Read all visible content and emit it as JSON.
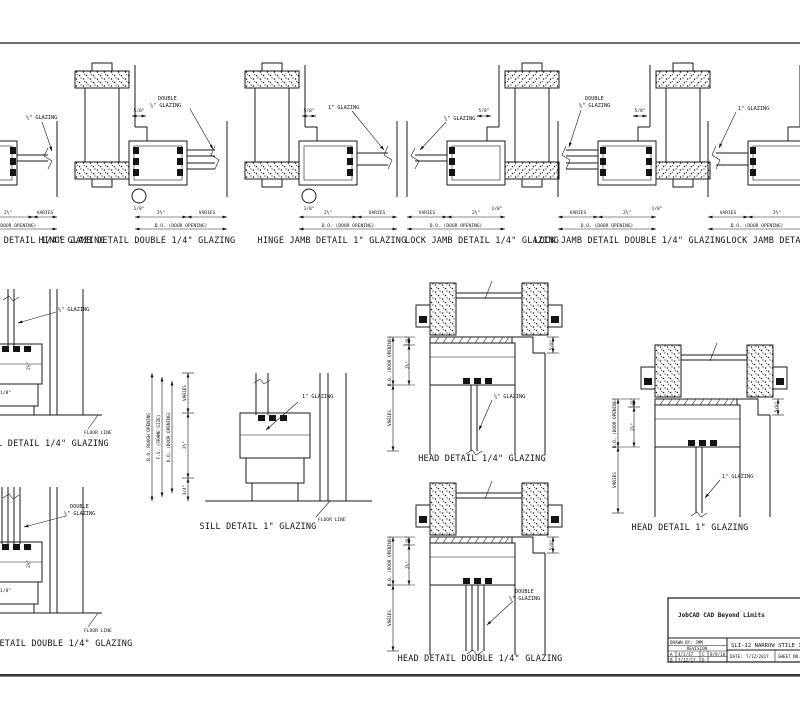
{
  "labels": {
    "glazing_quarter": "¼\" GLAZING",
    "glazing_double": "DOUBLE",
    "glazing_one": "1\" GLAZING",
    "floor_line": "FLOOR LINE",
    "varies": "VARIES",
    "door_opening": "D.O. (DOOR OPENING)",
    "rough_opening": "R.O. ROUGH OPENING",
    "frame_size": "F.S. (FRAME SIZE)",
    "dim_5_8": "5/8\"",
    "dim_1_8": "1/8\"",
    "dim_2_5": "2½\"",
    "dim_3_4": "3/4\""
  },
  "details": {
    "hinge_jamb_quarter": {
      "caption": "HINGE JAMB DETAIL 1/4\" GLAZING"
    },
    "hinge_jamb_double": {
      "caption": "HINGE JAMB DETAIL DOUBLE 1/4\" GLAZING"
    },
    "hinge_jamb_one": {
      "caption": "HINGE JAMB DETAIL 1\" GLAZING"
    },
    "lock_jamb_quarter": {
      "caption": "LOCK JAMB DETAIL 1/4\" GLAZING"
    },
    "lock_jamb_double": {
      "caption": "LOCK JAMB DETAIL DOUBLE 1/4\" GLAZING"
    },
    "lock_jamb_one": {
      "caption": "LOCK JAMB DETAIL 1\" GLAZING"
    },
    "sill_quarter": {
      "caption": "SILL DETAIL 1/4\" GLAZING"
    },
    "sill_double": {
      "caption": "SILL DETAIL DOUBLE 1/4\" GLAZING"
    },
    "sill_one": {
      "caption": "SILL DETAIL 1\" GLAZING"
    },
    "head_quarter": {
      "caption": "HEAD DETAIL 1/4\" GLAZING"
    },
    "head_double": {
      "caption": "HEAD DETAIL DOUBLE 1/4\" GLAZING"
    },
    "head_one": {
      "caption": "HEAD DETAIL 1\" GLAZING"
    }
  },
  "title_block": {
    "logo": "JobCAD CAD Beyond Limits",
    "drawn_by": "DRAWN BY: JMM",
    "revision_label": "REVISION",
    "rev_a": "A",
    "rev_a_date": "4/3/17",
    "rev_b": "B",
    "rev_b_date": "7/12/17",
    "rev_c": "C",
    "rev_c_date": "8/9/18",
    "rev_d": "D",
    "drawing_title": "SLI-12 NARROW STILE INTERIOR A",
    "date_label": "DATE:",
    "date_value": "7/12/2017",
    "sheet_no": "SHEET NO. 1"
  }
}
